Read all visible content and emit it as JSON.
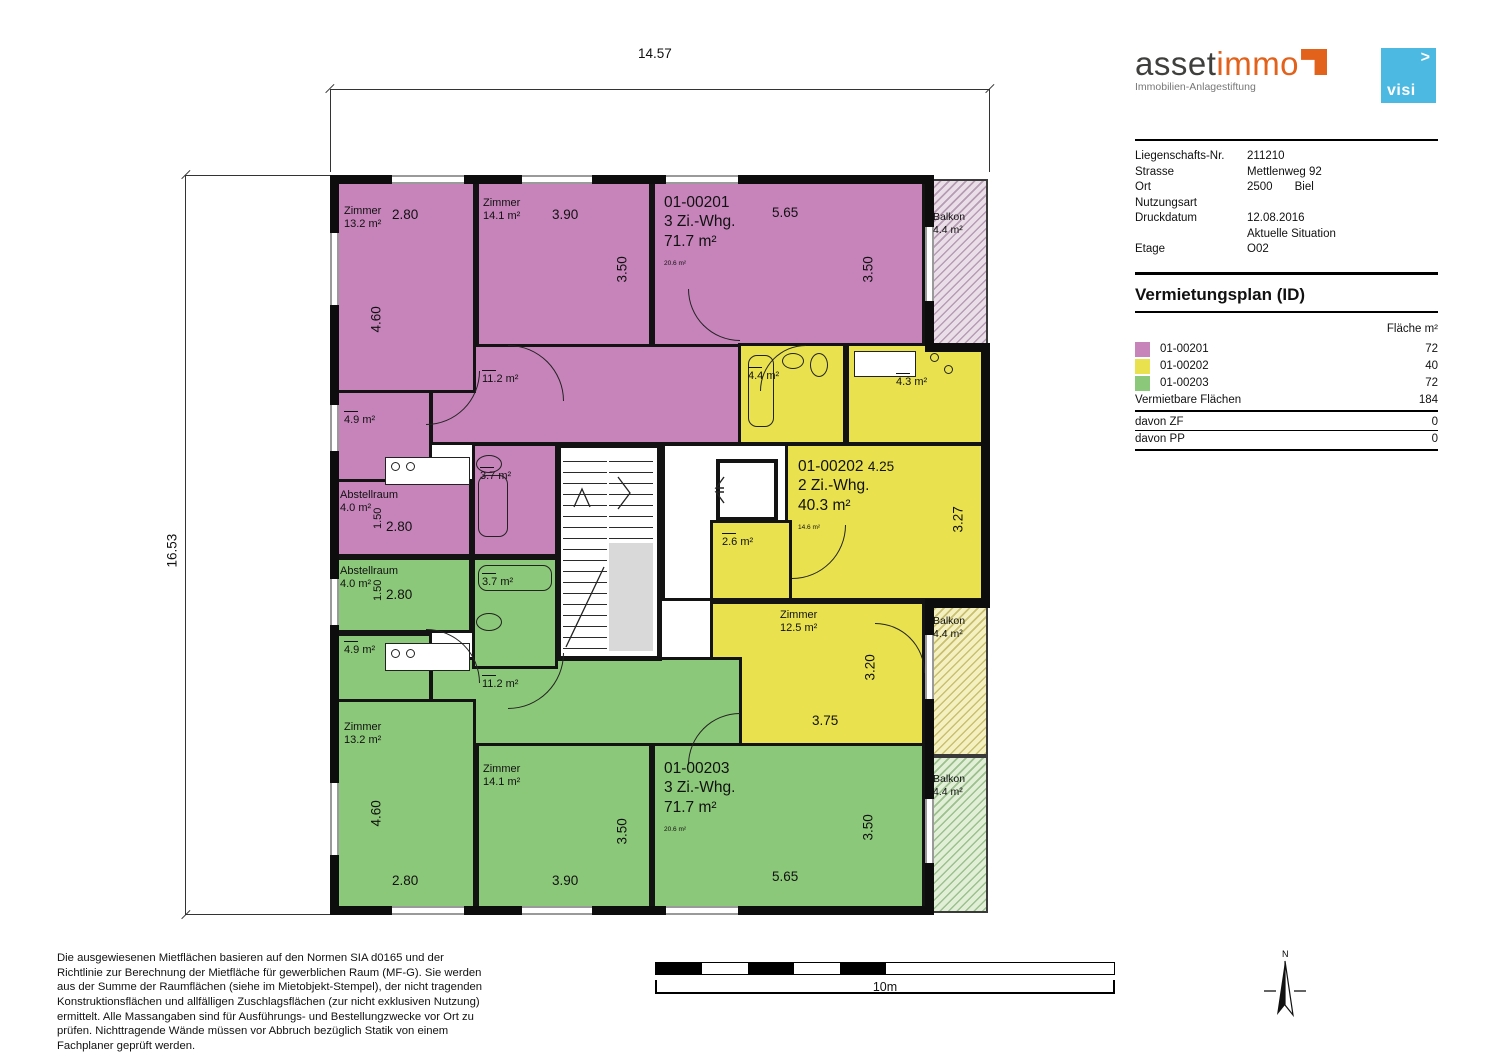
{
  "header": {
    "logo": {
      "part1": "asset",
      "part2": "immo",
      "subtitle": "Immobilien-Anlagestiftung"
    },
    "visi": {
      "label": "visi",
      "arrow": ">"
    },
    "info": [
      {
        "label": "Liegenschafts-Nr.",
        "value": "211210"
      },
      {
        "label": "Strasse",
        "value": "Mettlenweg 92"
      },
      {
        "label": "Ort",
        "value": "2500",
        "value2": "Biel"
      },
      {
        "label": "Nutzungsart",
        "value": ""
      },
      {
        "label": "Druckdatum",
        "value": "12.08.2016"
      },
      {
        "label": "",
        "value": "Aktuelle Situation"
      },
      {
        "label": "Etage",
        "value": "O02"
      }
    ]
  },
  "legend": {
    "title": "Vermietungsplan (ID)",
    "col_header": "Fläche m²",
    "rows": [
      {
        "id": "01-00201",
        "area": "72",
        "color": "#c684ba"
      },
      {
        "id": "01-00202",
        "area": "40",
        "color": "#e9e24e"
      },
      {
        "id": "01-00203",
        "area": "72",
        "color": "#8cc87a"
      }
    ],
    "total_label": "Vermietbare Flächen",
    "total": "184",
    "zf_label": "davon ZF",
    "zf": "0",
    "pp_label": "davon PP",
    "pp": "0"
  },
  "plan": {
    "dims": {
      "top": "14.57",
      "left": "16.53",
      "d280": "2.80",
      "d460": "4.60",
      "d390": "3.90",
      "d350": "3.50",
      "d565": "5.65",
      "d150": "1.50",
      "d425": "4.25",
      "d327": "3.27",
      "d375": "3.75",
      "d320": "3.20"
    },
    "labels": {
      "zimmer": "Zimmer",
      "balkon": "Balkon",
      "abstellraum": "Abstellraum",
      "z132": "13.2 m²",
      "z141": "14.1 m²",
      "z125": "12.5 m²",
      "corridor": "11.2 m²",
      "bath37": "3.7 m²",
      "bath44": "4.4 m²",
      "kit43": "4.3 m²",
      "kit49": "4.9 m²",
      "abstell_area": "4.0 m²",
      "reduit": "2.6 m²",
      "balkon_area": "4.4 m²"
    },
    "apt1": {
      "id": "01-00201",
      "type": "3 Zi.-Whg.",
      "area": "71.7 m²",
      "stamp": "20.6 m²"
    },
    "apt2": {
      "id": "01-00202",
      "type": "2 Zi.-Whg.",
      "area": "40.3 m²",
      "stamp": "14.6 m²"
    },
    "apt3": {
      "id": "01-00203",
      "type": "3 Zi.-Whg.",
      "area": "71.7 m²",
      "stamp": "20.6 m²"
    }
  },
  "footer": {
    "disclaimer": "Die ausgewiesenen Mietflächen basieren auf den Normen SIA d0165 und der Richtlinie zur Berechnung der Mietfläche für gewerblichen Raum (MF-G). Sie werden aus der Summe der Raumflächen (siehe im Mietobjekt-Stempel), der nicht tragenden Konstruktionsflächen und allfälligen Zuschlagsflächen (zur nicht exklusiven Nutzung) ermittelt. Alle Massangaben sind für Ausführungs- und Bestellungzwecke vor Ort zu prüfen. Nichttragende Wände müssen vor Abbruch bezüglich Statik von einem Fachplaner geprüft werden.",
    "scale_label": "10m",
    "north_label": "N"
  }
}
